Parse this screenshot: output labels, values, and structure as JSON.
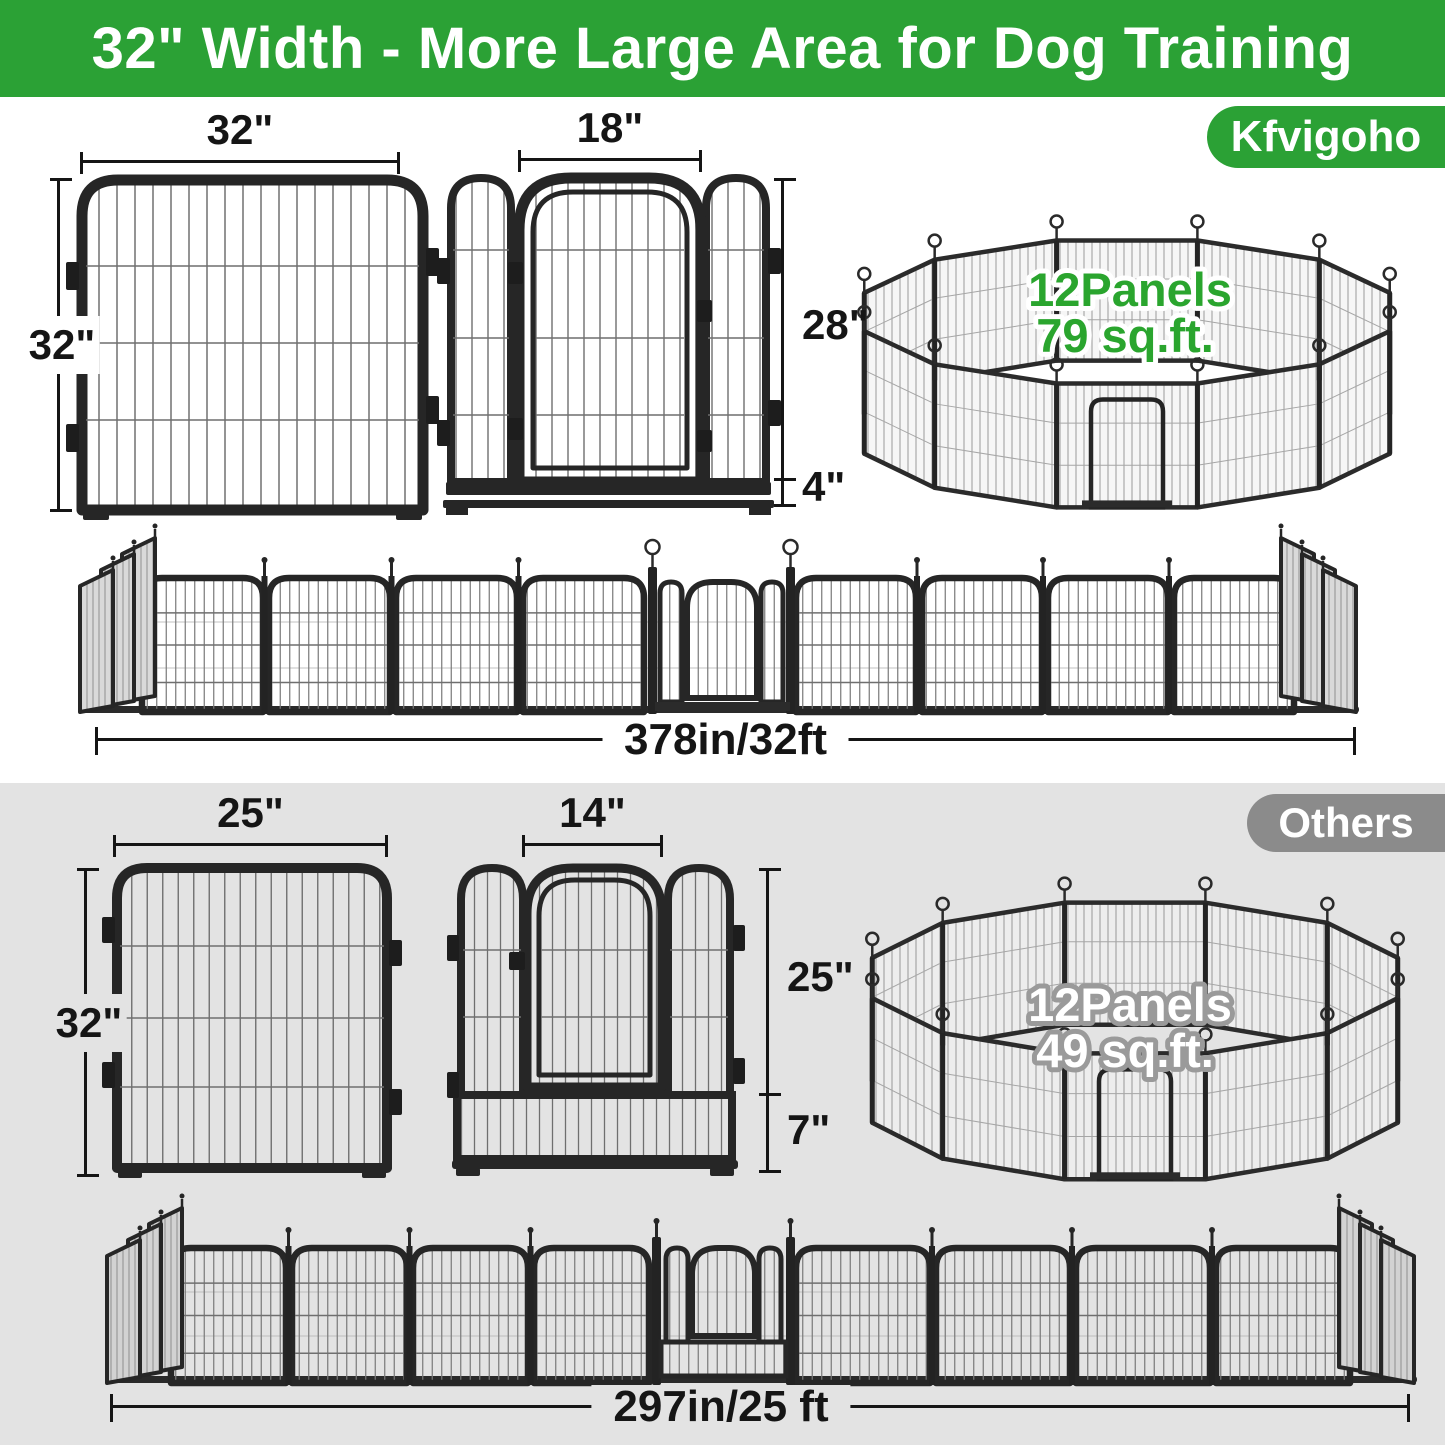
{
  "banner": {
    "title": "32\" Width - More Large Area for Dog Training",
    "bg_color": "#2ba135",
    "text_color": "#ffffff"
  },
  "brand": {
    "badge_label": "Kfvigoho",
    "panel_diagram": {
      "width_label": "32\"",
      "height_label": "32\""
    },
    "door_diagram": {
      "door_width_label": "18\"",
      "door_height_label": "28\"",
      "bottom_height_label": "4\""
    },
    "pen_diagram": {
      "panels_label": "12Panels",
      "area_label": "79 sq.ft.",
      "text_color": "#2aa52e"
    },
    "row_diagram": {
      "total_length_label": "378in/32ft"
    }
  },
  "others": {
    "badge_label": "Others",
    "panel_diagram": {
      "width_label": "25\"",
      "height_label": "32\""
    },
    "door_diagram": {
      "door_width_label": "14\"",
      "door_height_label": "25\"",
      "bottom_height_label": "7\""
    },
    "pen_diagram": {
      "panels_label": "12Panels",
      "area_label": "49 sq.ft.",
      "text_color": "#ffffff"
    },
    "row_diagram": {
      "total_length_label": "297in/25 ft"
    }
  },
  "colors": {
    "brand_green": "#2ba135",
    "others_gray": "#8b8b8b",
    "others_bg": "#e3e3e3",
    "dimension": "#151515",
    "fence_frame": "#262626"
  }
}
